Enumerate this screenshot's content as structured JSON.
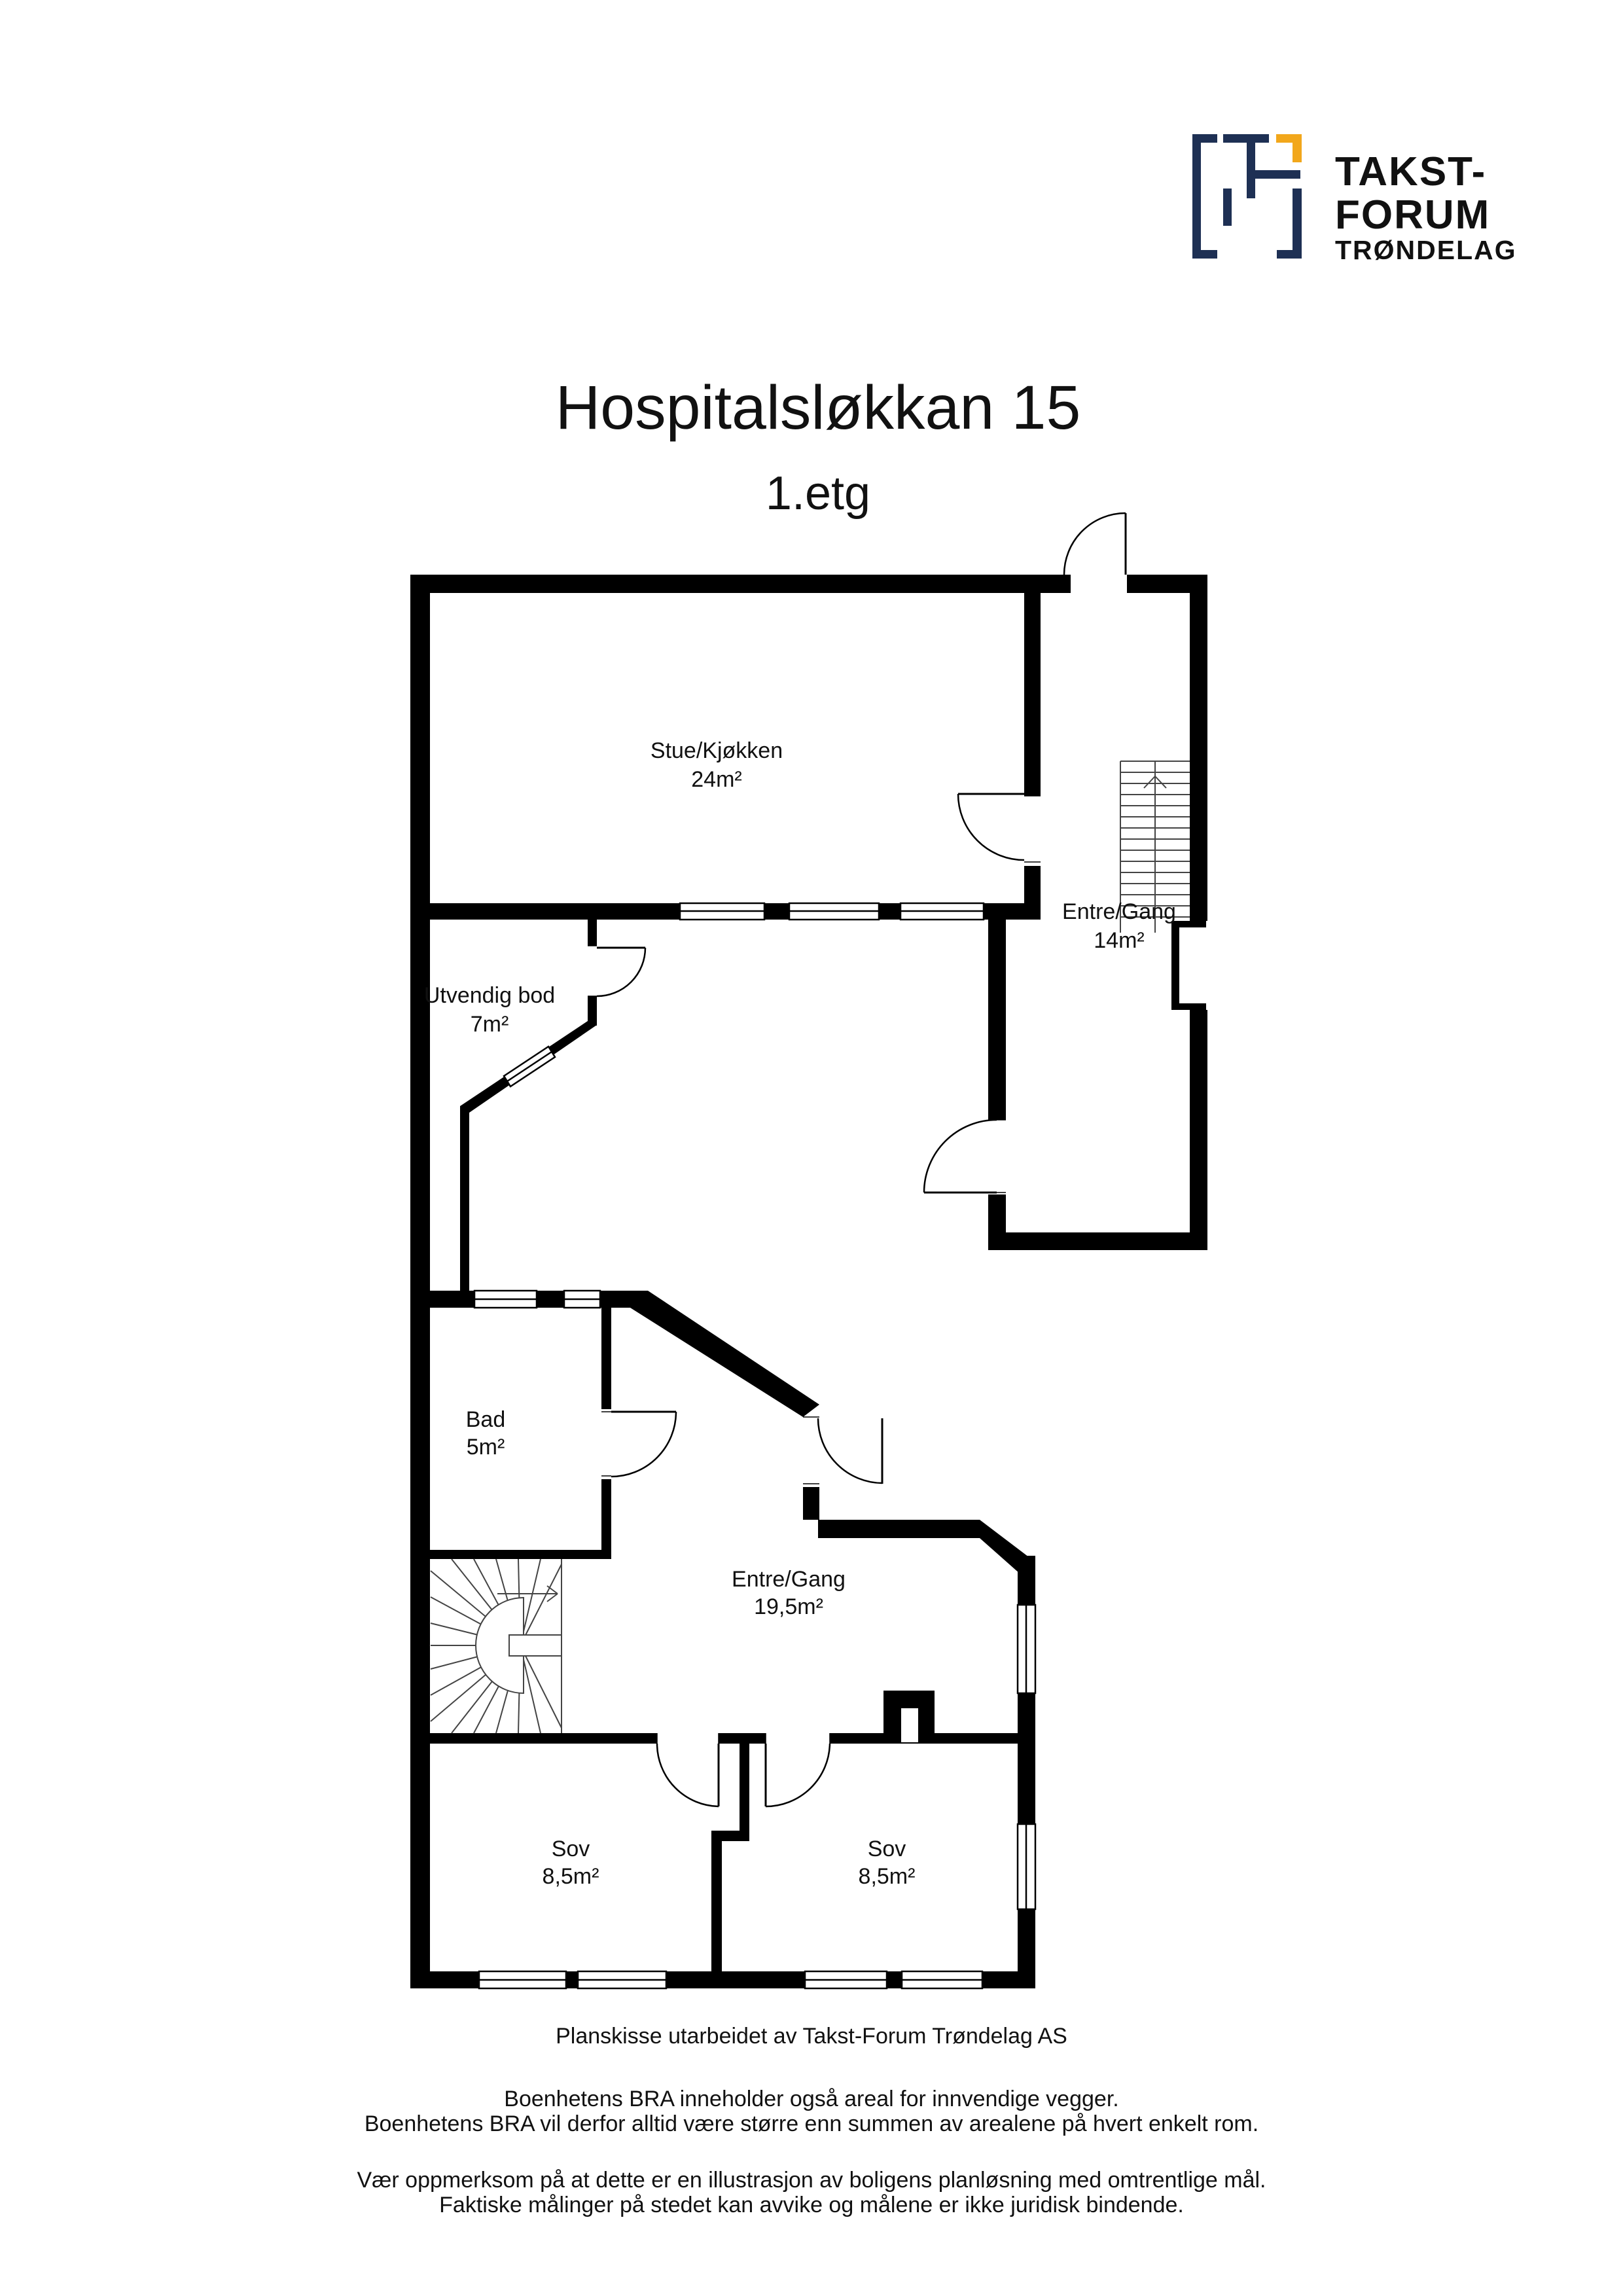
{
  "header": {
    "title": "Hospitalsløkkan 15",
    "subtitle": "1.etg"
  },
  "logo": {
    "line1": "TAKST-",
    "line2": "FORUM",
    "line3": "TRØNDELAG",
    "navy": "#1e3054",
    "yellow": "#f2a71b"
  },
  "rooms": [
    {
      "name": "Stue/Kjøkken",
      "area": "24m²"
    },
    {
      "name": "Entre/Gang",
      "area": "14m²"
    },
    {
      "name": "Utvendig bod",
      "area": "7m²"
    },
    {
      "name": "Bad",
      "area": "5m²"
    },
    {
      "name": "Entre/Gang",
      "area": "19,5m²"
    },
    {
      "name": "Sov",
      "area": "8,5m²"
    },
    {
      "name": "Sov",
      "area": "8,5m²"
    }
  ],
  "footer": {
    "line1": "Planskisse utarbeidet av Takst-Forum Trøndelag AS",
    "line2": "Boenhetens BRA inneholder også areal for innvendige vegger.",
    "line3": "Boenhetens BRA vil derfor alltid være større enn summen av arealene på hvert enkelt rom.",
    "line4": "Vær oppmerksom på at dette er en illustrasjon av boligens planløsning med omtrentlige mål.",
    "line5": "Faktiske målinger på stedet kan avvike og målene er ikke juridisk bindende."
  },
  "colors": {
    "wall": "#000000",
    "text": "#111111",
    "background": "#ffffff"
  }
}
